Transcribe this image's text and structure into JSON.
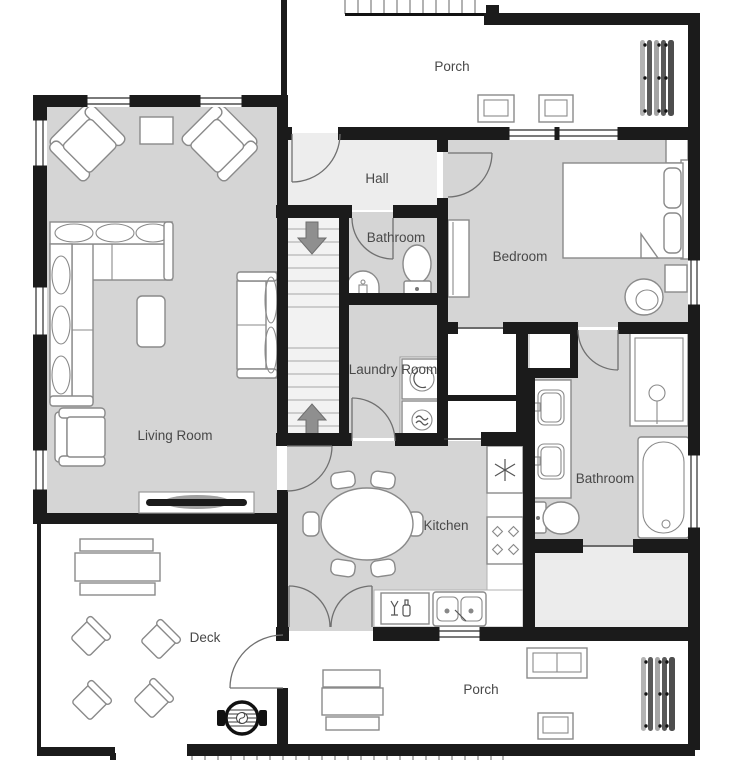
{
  "title": "House floor plan",
  "palette": {
    "wall": "#1b1b1b",
    "room": "#d5d5d5",
    "hall": "#ededed",
    "stairwell": "#f2f2f2",
    "storage": "#ececec",
    "furStroke": "#8a8a8a",
    "doorStroke": "#707070",
    "label": "#484848",
    "arrow": "#8f8f8f"
  },
  "rooms": {
    "porch_top": {
      "label": "Porch"
    },
    "hall": {
      "label": "Hall"
    },
    "bathroom_small": {
      "label": "Bathroom"
    },
    "bedroom": {
      "label": "Bedroom"
    },
    "laundry_room": {
      "label": "Laundry Room"
    },
    "living_room": {
      "label": "Living Room"
    },
    "kitchen": {
      "label": "Kitchen"
    },
    "bathroom_main": {
      "label": "Bathroom"
    },
    "deck": {
      "label": "Deck"
    },
    "porch_bottom": {
      "label": "Porch"
    }
  }
}
